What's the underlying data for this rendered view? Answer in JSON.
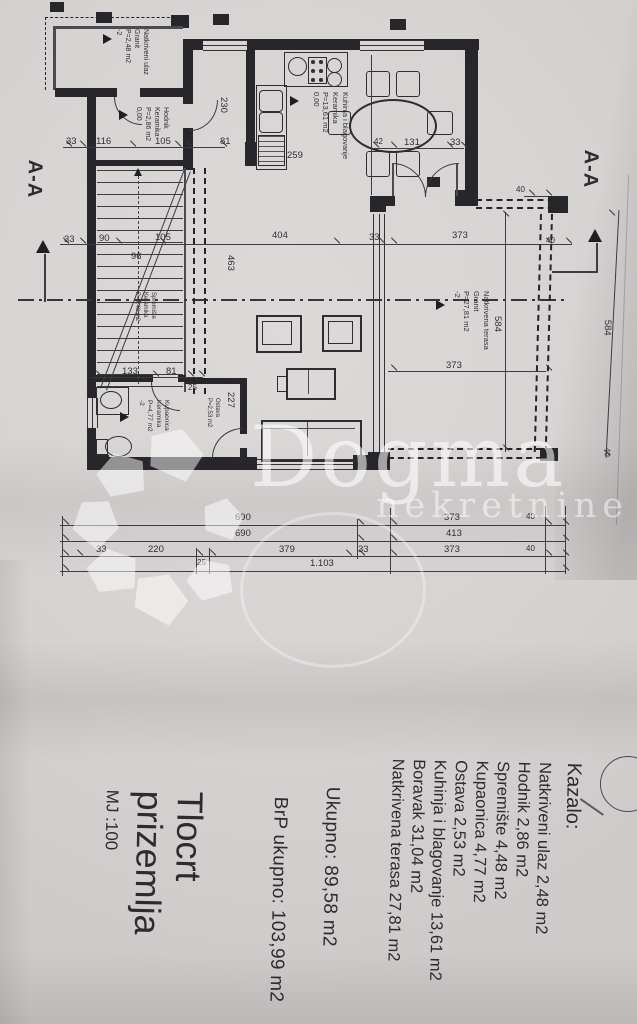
{
  "watermark": {
    "brand": "Dogma",
    "subtitle": "nekretnine"
  },
  "section": {
    "label_left": "A-A",
    "label_right": "A-A"
  },
  "title_block": {
    "title_line1": "Tlocrt",
    "title_line2": "prizemlja",
    "scale": "MJ :100"
  },
  "legend": {
    "heading": "Kazalo:",
    "items": [
      "Natkriveni ulaz 2,48 m2",
      "Hodnik 2,86 m2",
      "Spremište 4,48 m2",
      "Kupaonica 4,77 m2",
      "Ostava 2,53 m2",
      "Kuhinja i blagovanje 13,61 m2",
      "Boravak 31,04 m2",
      "Natkrivena terasa 27,81 m2"
    ],
    "total": "Ukupno: 89,58 m2",
    "gross_total": "BrP ukupno: 103,99 m2"
  },
  "plan": {
    "room_labels": [
      {
        "x": 150,
        "y": 29,
        "fs": 7,
        "lines": [
          "Natkriveni ulaz",
          "Granit",
          "P=2,48 m2",
          "-2"
        ]
      },
      {
        "x": 170,
        "y": 107,
        "fs": 7,
        "lines": [
          "Hodnik",
          "Keramika",
          "P=2,86 m2",
          "0,00"
        ]
      },
      {
        "x": 350,
        "y": 92,
        "fs": 7.5,
        "lines": [
          "Kuhinja i blagovanje",
          "Keramika",
          "P=13,61 m2",
          "0,00"
        ]
      },
      {
        "x": 491,
        "y": 291,
        "fs": 7.5,
        "lines": [
          "Natkrivena terasa",
          "Granit",
          "P=27,81 m2",
          "-2"
        ]
      },
      {
        "x": 170,
        "y": 400,
        "fs": 6.5,
        "lines": [
          "Kupaonica",
          "Keramika",
          "P=4,77 m2",
          "-2"
        ]
      },
      {
        "x": 156,
        "y": 292,
        "fs": 6,
        "lines": [
          "Spremište",
          "Keramika",
          "P=4,48 m2"
        ]
      },
      {
        "x": 220,
        "y": 398,
        "fs": 6,
        "lines": [
          "Ostava",
          "P=2,53 m2"
        ]
      }
    ],
    "level_markers": [
      [
        103,
        34
      ],
      [
        119,
        110
      ],
      [
        290,
        96
      ],
      [
        436,
        300
      ],
      [
        120,
        412
      ]
    ],
    "dimensions": [
      {
        "t": "33",
        "x": 64,
        "y": 234
      },
      {
        "t": "90",
        "x": 99,
        "y": 233
      },
      {
        "t": "105",
        "x": 155,
        "y": 232
      },
      {
        "t": "404",
        "x": 272,
        "y": 230
      },
      {
        "t": "33",
        "x": 369,
        "y": 232
      },
      {
        "t": "373",
        "x": 452,
        "y": 230
      },
      {
        "t": "40",
        "x": 546,
        "y": 236,
        "fs": 8
      },
      {
        "t": "96",
        "x": 131,
        "y": 251
      },
      {
        "t": "463",
        "x": 236,
        "y": 255,
        "r": 90
      },
      {
        "t": "230",
        "x": 229,
        "y": 97,
        "r": 90
      },
      {
        "t": "259",
        "x": 287,
        "y": 150
      },
      {
        "t": "227",
        "x": 236,
        "y": 392,
        "r": 90
      },
      {
        "t": "584",
        "x": 503,
        "y": 316,
        "r": 90
      },
      {
        "t": "584",
        "x": 613,
        "y": 320,
        "r": 92
      },
      {
        "t": "40",
        "x": 612,
        "y": 448,
        "r": 92,
        "fs": 8
      },
      {
        "t": "40",
        "x": 516,
        "y": 185,
        "fs": 8
      },
      {
        "t": "373",
        "x": 446,
        "y": 360
      },
      {
        "t": "33",
        "x": 66,
        "y": 136
      },
      {
        "t": "116",
        "x": 96,
        "y": 136
      },
      {
        "t": "105",
        "x": 155,
        "y": 136
      },
      {
        "t": "25",
        "x": 184,
        "y": 138,
        "fs": 8
      },
      {
        "t": "81",
        "x": 220,
        "y": 136
      },
      {
        "t": "42",
        "x": 374,
        "y": 137,
        "fs": 8
      },
      {
        "t": "131",
        "x": 404,
        "y": 137
      },
      {
        "t": "33",
        "x": 450,
        "y": 137
      },
      {
        "t": "133",
        "x": 122,
        "y": 366
      },
      {
        "t": "81",
        "x": 166,
        "y": 366
      },
      {
        "t": "25",
        "x": 188,
        "y": 383,
        "fs": 8
      },
      {
        "t": "690",
        "x": 235,
        "y": 512
      },
      {
        "t": "373",
        "x": 444,
        "y": 512
      },
      {
        "t": "40",
        "x": 526,
        "y": 512,
        "fs": 8
      },
      {
        "t": "690",
        "x": 235,
        "y": 528
      },
      {
        "t": "413",
        "x": 446,
        "y": 528
      },
      {
        "t": "33",
        "x": 96,
        "y": 544
      },
      {
        "t": "220",
        "x": 148,
        "y": 544
      },
      {
        "t": "25",
        "x": 197,
        "y": 558,
        "fs": 8
      },
      {
        "t": "379",
        "x": 279,
        "y": 544
      },
      {
        "t": "33",
        "x": 358,
        "y": 544
      },
      {
        "t": "373",
        "x": 444,
        "y": 544
      },
      {
        "t": "40",
        "x": 526,
        "y": 544,
        "fs": 8
      },
      {
        "t": "1.103",
        "x": 310,
        "y": 558
      }
    ],
    "lines": [
      {
        "k": "ax",
        "x": 18,
        "y": 299,
        "w": 550
      },
      {
        "k": "l",
        "x": 60,
        "y": 244,
        "w": 512,
        "h": 1
      },
      {
        "k": "l",
        "x": 63,
        "y": 147,
        "w": 162,
        "h": 1
      },
      {
        "k": "l",
        "x": 370,
        "y": 148,
        "w": 94,
        "h": 1
      },
      {
        "k": "l",
        "x": 93,
        "y": 377,
        "w": 110,
        "h": 1
      },
      {
        "k": "l",
        "x": 388,
        "y": 371,
        "w": 158,
        "h": 1
      },
      {
        "k": "l",
        "x": 505,
        "y": 212,
        "w": 1,
        "h": 240
      },
      {
        "k": "l",
        "x": 60,
        "y": 525,
        "w": 505,
        "h": 1
      },
      {
        "k": "l",
        "x": 60,
        "y": 541,
        "w": 505,
        "h": 1
      },
      {
        "k": "l",
        "x": 60,
        "y": 556,
        "w": 505,
        "h": 1
      },
      {
        "k": "l",
        "x": 60,
        "y": 571,
        "w": 505,
        "h": 1
      },
      {
        "k": "l",
        "x": 62,
        "y": 516,
        "w": 1,
        "h": 60
      },
      {
        "k": "l",
        "x": 357,
        "y": 519,
        "w": 1,
        "h": 40
      },
      {
        "k": "l",
        "x": 390,
        "y": 508,
        "w": 1,
        "h": 66
      },
      {
        "k": "l",
        "x": 545,
        "y": 506,
        "w": 1,
        "h": 68
      },
      {
        "k": "l",
        "x": 565,
        "y": 506,
        "w": 1,
        "h": 68
      },
      {
        "k": "l",
        "x": 196,
        "y": 548,
        "w": 1,
        "h": 26
      },
      {
        "k": "l",
        "x": 209,
        "y": 548,
        "w": 1,
        "h": 26
      },
      {
        "k": "l",
        "x": 524,
        "y": 196,
        "w": 24,
        "h": 1
      },
      {
        "k": "l",
        "x": 612,
        "y": 210,
        "w": 1,
        "h": 248,
        "r": 3
      },
      {
        "k": "l",
        "x": 552,
        "y": 271,
        "w": 46,
        "h": 1.5
      },
      {
        "k": "l",
        "x": 596,
        "y": 243,
        "w": 1.5,
        "h": 30
      },
      {
        "k": "l",
        "x": 44,
        "y": 254,
        "w": 2,
        "h": 48
      },
      {
        "k": "l",
        "x": 371,
        "y": 55,
        "w": 1,
        "h": 140
      },
      {
        "k": "l",
        "x": 622,
        "y": 175,
        "w": 1,
        "h": 350,
        "r": 2,
        "c": "rgba(70,70,75,0.3)"
      },
      {
        "k": "dh",
        "x": 476,
        "y": 199,
        "w": 88
      },
      {
        "k": "dh",
        "x": 476,
        "y": 207,
        "w": 88
      },
      {
        "k": "dv",
        "x": 540,
        "y": 214,
        "h": 238,
        "r": 1.5
      },
      {
        "k": "dv",
        "x": 551,
        "y": 214,
        "h": 238,
        "r": 1.5
      },
      {
        "k": "dh",
        "x": 388,
        "y": 448,
        "w": 154
      },
      {
        "k": "dh",
        "x": 388,
        "y": 457,
        "w": 154
      },
      {
        "k": "dv",
        "x": 193,
        "y": 168,
        "h": 226
      },
      {
        "k": "dv",
        "x": 204,
        "y": 168,
        "h": 226
      },
      {
        "k": "dh",
        "x": 45,
        "y": 17,
        "w": 140,
        "thin": true
      },
      {
        "k": "dv",
        "x": 45,
        "y": 17,
        "h": 73,
        "thin": true
      },
      {
        "k": "wl",
        "x": 138,
        "y": 176,
        "h": 208
      }
    ],
    "ticks": [
      [
        62,
        240
      ],
      [
        79,
        240
      ],
      [
        115,
        240
      ],
      [
        159,
        240
      ],
      [
        333,
        240
      ],
      [
        378,
        240
      ],
      [
        390,
        240
      ],
      [
        545,
        240
      ],
      [
        565,
        240
      ],
      [
        65,
        143
      ],
      [
        79,
        143
      ],
      [
        129,
        143
      ],
      [
        174,
        143
      ],
      [
        185,
        143
      ],
      [
        220,
        143
      ],
      [
        372,
        144
      ],
      [
        390,
        144
      ],
      [
        446,
        144
      ],
      [
        460,
        144
      ],
      [
        95,
        373
      ],
      [
        152,
        373
      ],
      [
        187,
        373
      ],
      [
        198,
        373
      ],
      [
        390,
        367
      ],
      [
        545,
        367
      ],
      [
        528,
        192
      ],
      [
        545,
        192
      ],
      [
        62,
        521
      ],
      [
        357,
        521
      ],
      [
        390,
        521
      ],
      [
        545,
        521
      ],
      [
        562,
        521
      ],
      [
        62,
        537
      ],
      [
        357,
        537
      ],
      [
        390,
        537
      ],
      [
        562,
        537
      ],
      [
        62,
        552
      ],
      [
        76,
        552
      ],
      [
        196,
        552
      ],
      [
        209,
        552
      ],
      [
        345,
        552
      ],
      [
        358,
        552
      ],
      [
        390,
        552
      ],
      [
        545,
        552
      ],
      [
        562,
        552
      ],
      [
        62,
        567
      ],
      [
        562,
        567
      ],
      [
        502,
        213
      ],
      [
        502,
        447
      ],
      [
        608,
        212
      ],
      [
        603,
        452
      ]
    ]
  }
}
